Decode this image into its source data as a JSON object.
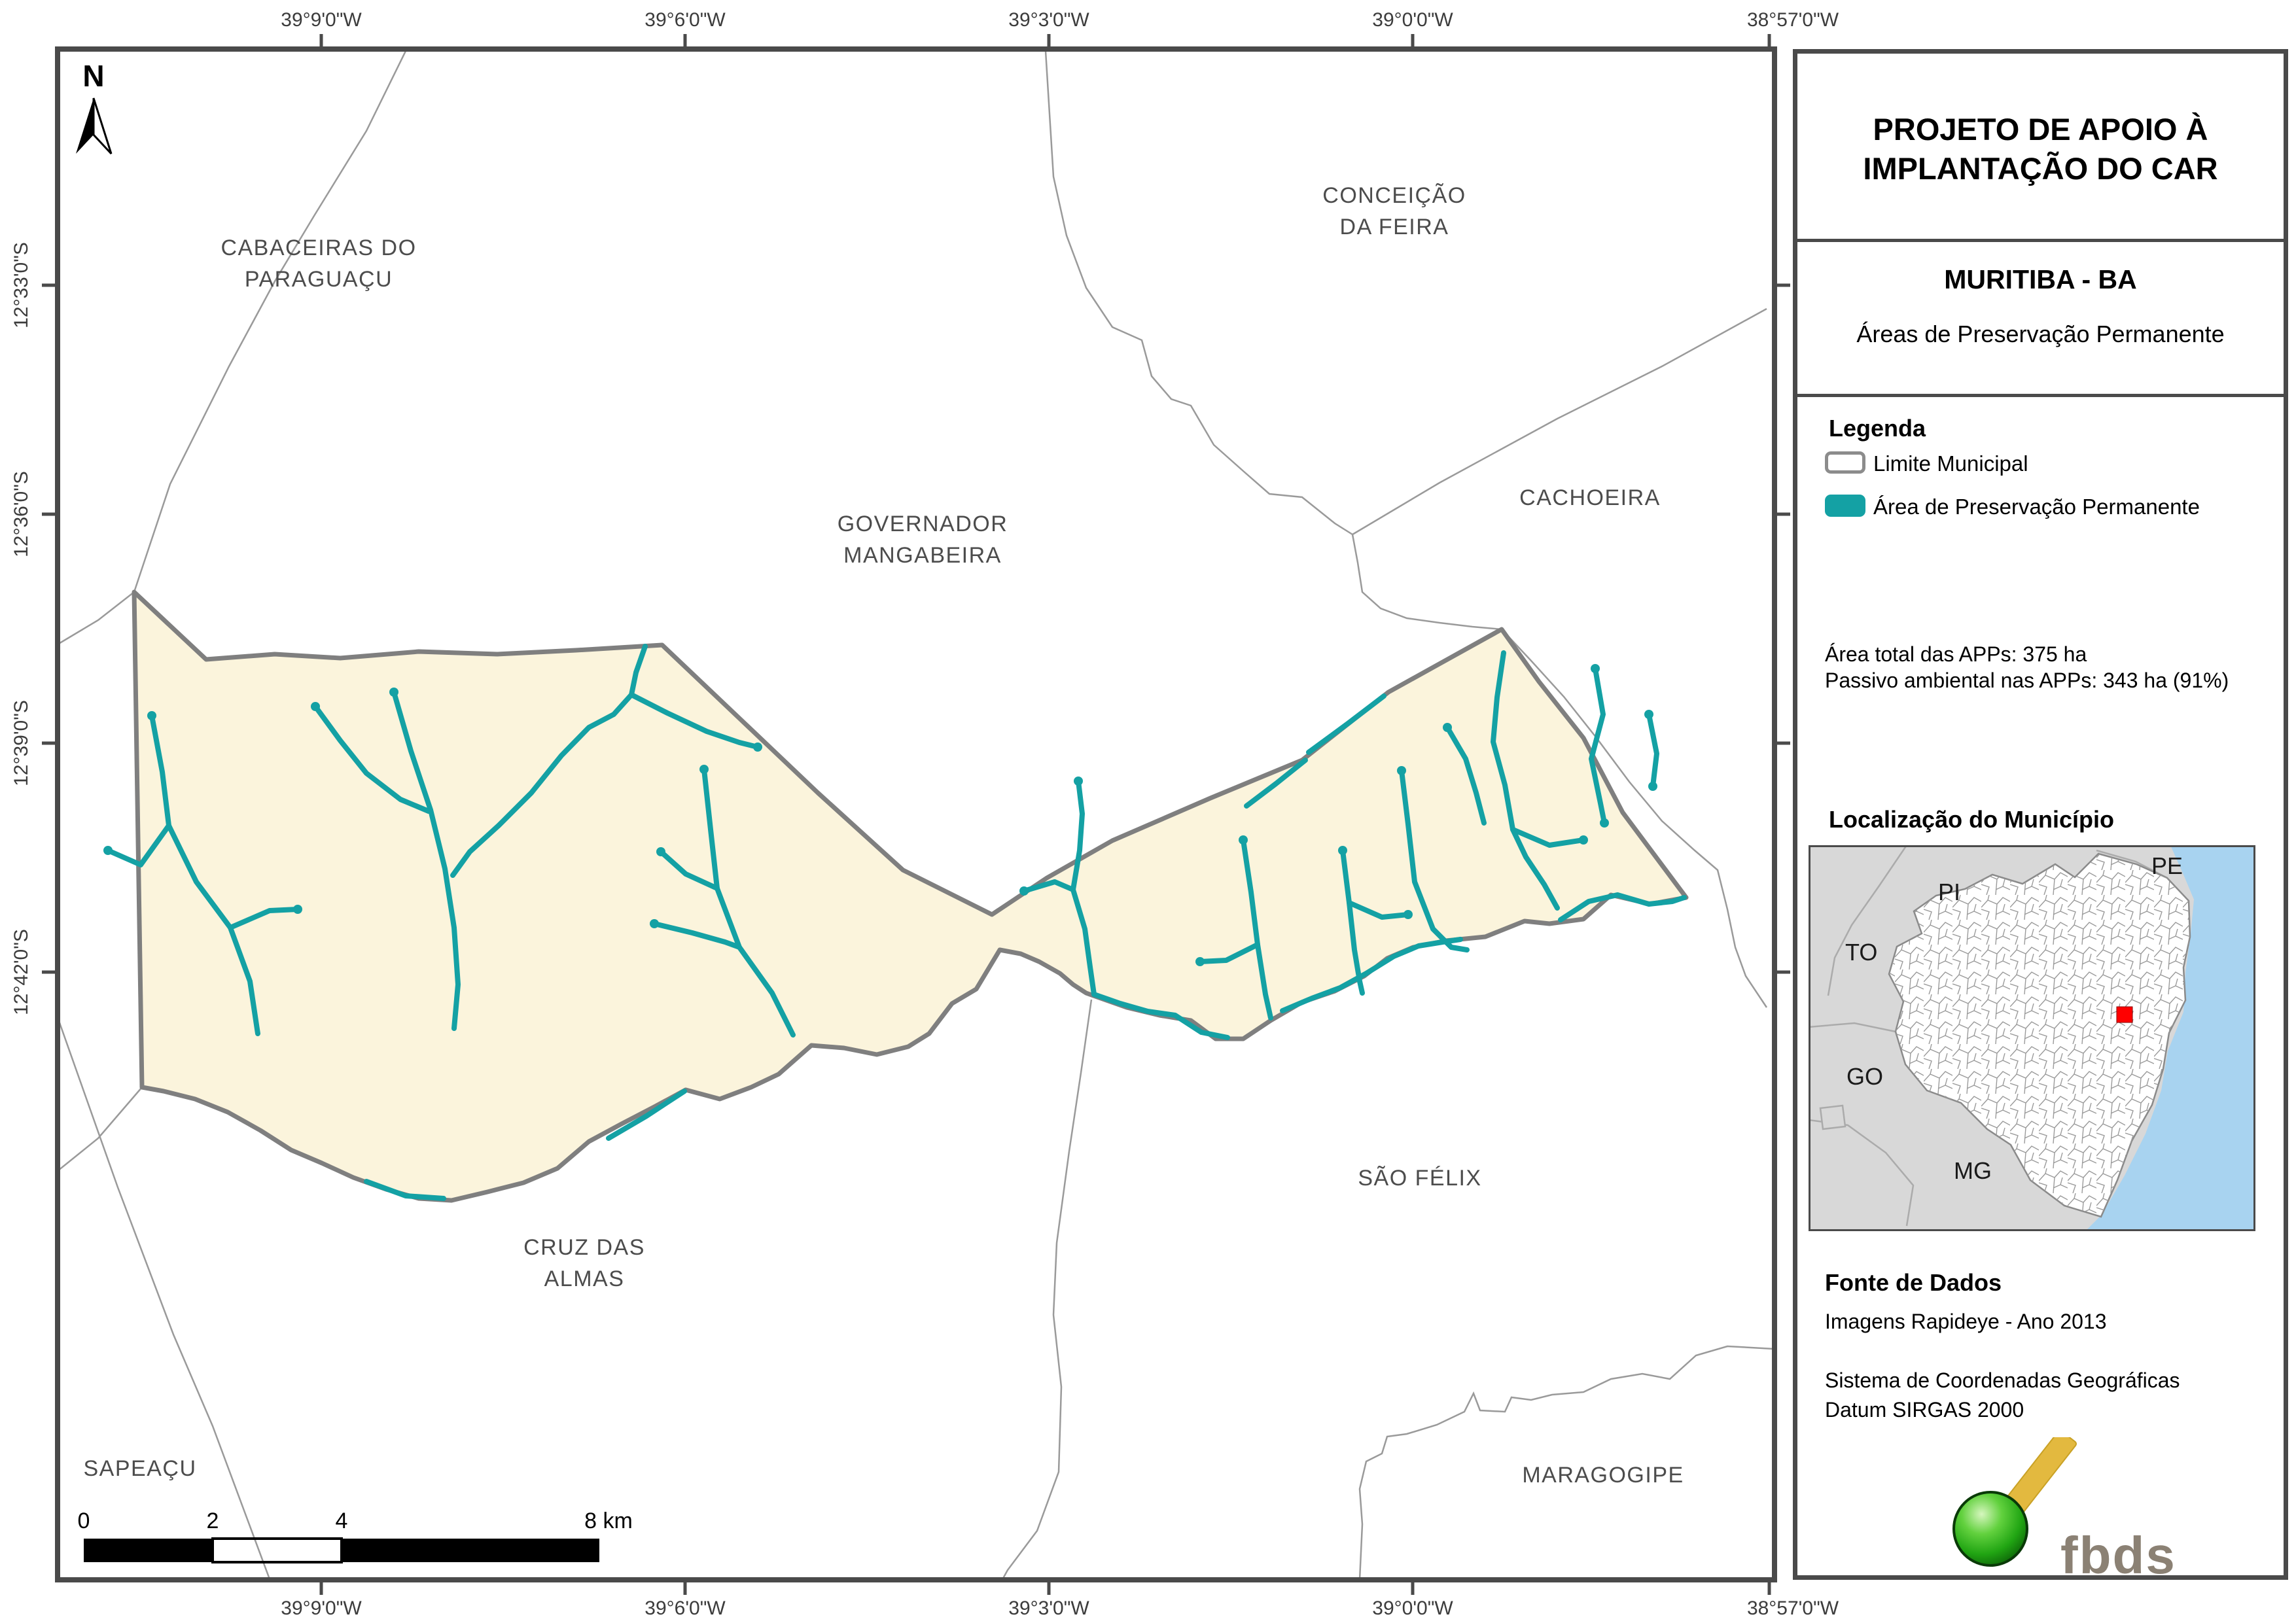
{
  "north_label": "N",
  "coordinates": {
    "top": [
      "39°9'0\"W",
      "39°6'0\"W",
      "39°3'0\"W",
      "39°0'0\"W",
      "38°57'0\"W"
    ],
    "bottom": [
      "39°9'0\"W",
      "39°6'0\"W",
      "39°3'0\"W",
      "39°0'0\"W",
      "38°57'0\"W"
    ],
    "left": [
      "12°33'0\"S",
      "12°36'0\"S",
      "12°39'0\"S",
      "12°42'0\"S"
    ]
  },
  "scalebar": {
    "labels": [
      "0",
      "2",
      "4",
      "8 km"
    ]
  },
  "map_labels": {
    "cabaceiras_l1": "CABACEIRAS DO",
    "cabaceiras_l2": "PARAGUAÇU",
    "conceicao_l1": "CONCEIÇÃO",
    "conceicao_l2": "DA FEIRA",
    "governador_l1": "GOVERNADOR",
    "governador_l2": "MANGABEIRA",
    "cachoeira": "CACHOEIRA",
    "sao_felix": "SÃO FÉLIX",
    "cruz_l1": "CRUZ DAS",
    "cruz_l2": "ALMAS",
    "sapeacu": "SAPEAÇU",
    "maragogipe": "MARAGOGIPE"
  },
  "sidebar": {
    "title_l1": "PROJETO DE APOIO À",
    "title_l2": "IMPLANTAÇÃO DO CAR",
    "municipality": "MURITIBA - BA",
    "subtitle": "Áreas de Preservação Permanente",
    "legend": {
      "title": "Legenda",
      "items": [
        {
          "label": "Limite Municipal"
        },
        {
          "label": "Área de Preservação Permanente"
        }
      ]
    },
    "stats": [
      "Área total das APPs: 375 ha",
      "Passivo ambiental nas APPs: 343 ha (91%)"
    ],
    "location_title": "Localização do Município",
    "inset": {
      "states": [
        "PI",
        "PE",
        "TO",
        "GO",
        "MG"
      ]
    },
    "source": {
      "title": "Fonte de Dados",
      "lines": [
        "Imagens Rapideye - Ano 2013",
        "Sistema de Coordenadas Geográficas",
        "Datum SIRGAS 2000"
      ]
    },
    "logo_text": "fbds"
  },
  "colors": {
    "app_teal": "#14A1A4",
    "municipality_fill": "#FBF4DC",
    "municipal_boundary": "#7F7F7F",
    "thin_boundary": "#9A9A9A",
    "frame": "#4A4A4A",
    "ocean": "#A8D3F0",
    "inset_neighbor_gray": "#D8D8D8",
    "location_marker_red": "#FF0000",
    "logo_green": "#2FA818",
    "logo_gold": "#E3B93F",
    "logo_text_color": "#8B8174"
  }
}
